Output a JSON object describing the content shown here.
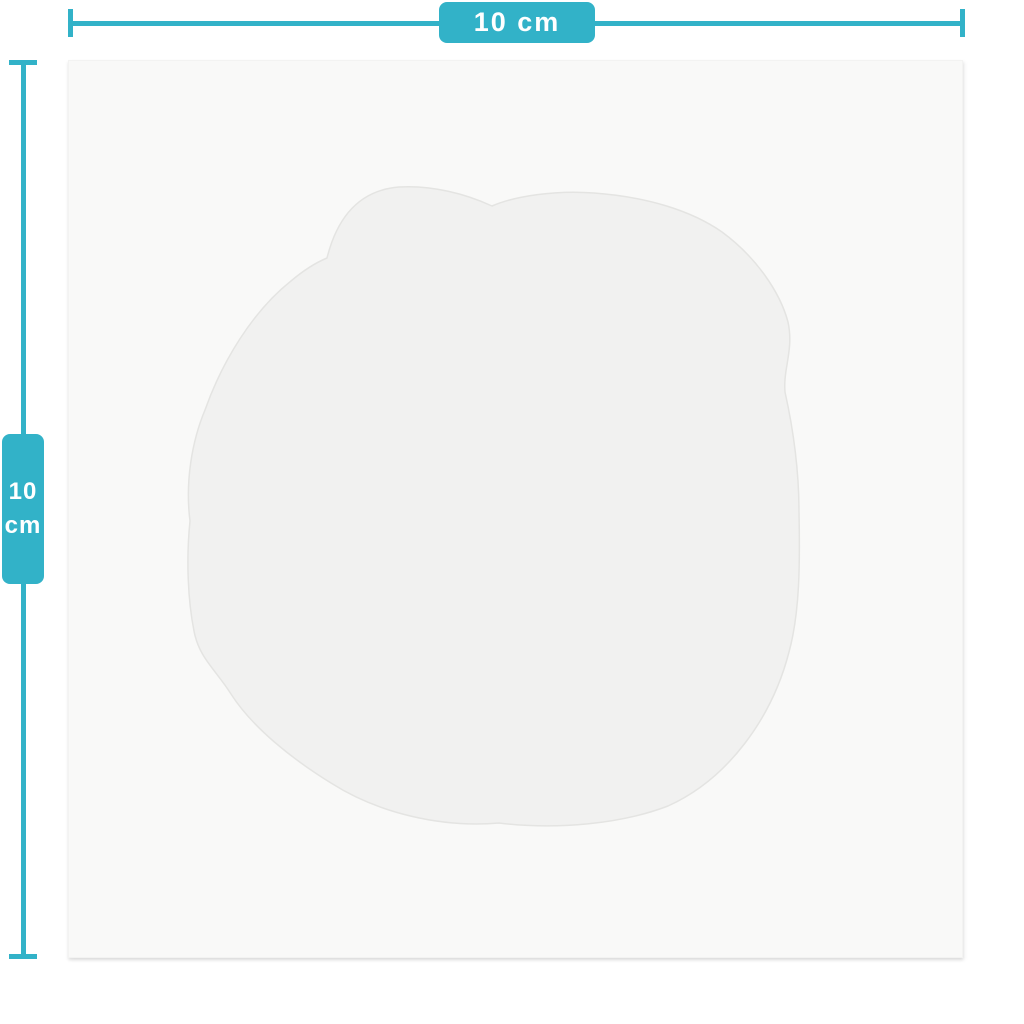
{
  "dimensions": {
    "width": {
      "label": "10 cm"
    },
    "height": {
      "value": "10",
      "unit": "cm"
    }
  },
  "colors": {
    "accent": "#32b2c8",
    "label_text": "#ffffff",
    "page_background": "#ffffff",
    "canvas_background": "#f9f9f8",
    "blob_fill": "#f1f1f0",
    "blob_edge": "#e4e4e2"
  }
}
